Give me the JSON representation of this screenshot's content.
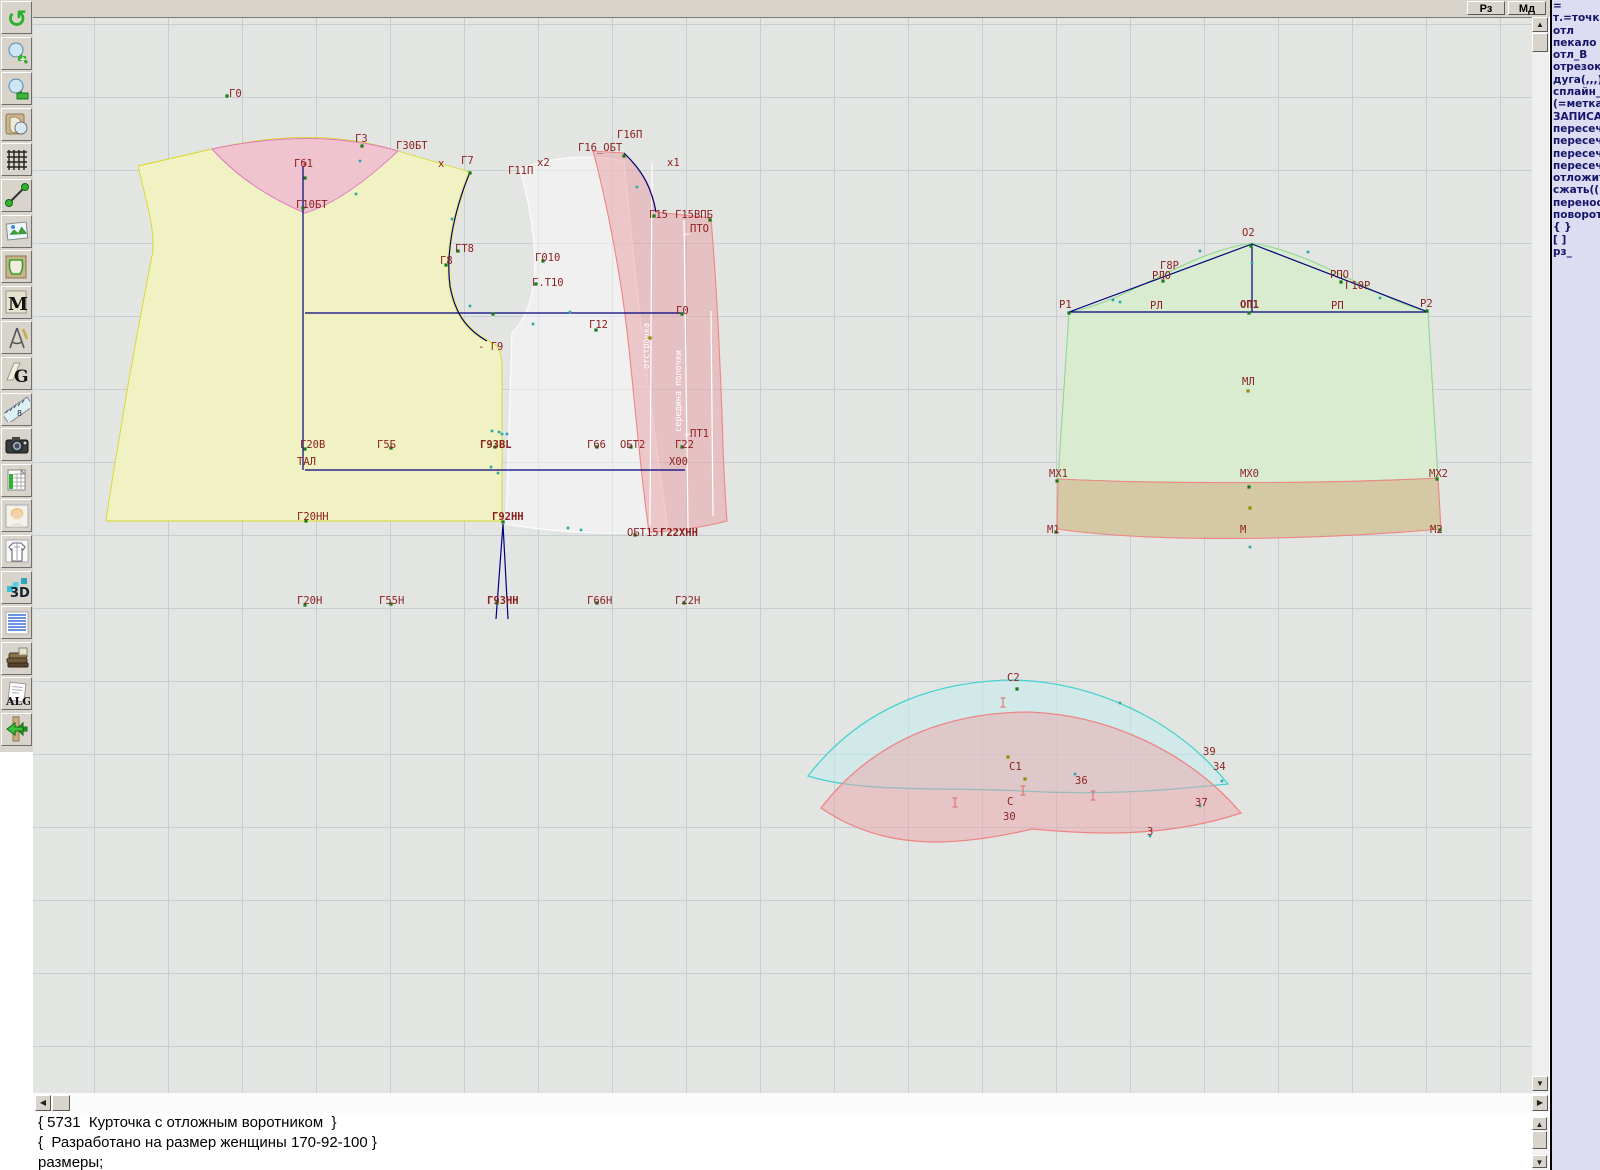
{
  "top_bar": {
    "buttons": [
      {
        "label": "Рз"
      },
      {
        "label": "Мд"
      }
    ]
  },
  "toolbar": {
    "items": [
      {
        "name": "undo-icon"
      },
      {
        "name": "zoom-in-icon"
      },
      {
        "name": "zoom-out-icon"
      },
      {
        "name": "preview-piece-icon"
      },
      {
        "name": "grid-icon"
      },
      {
        "name": "segment-icon"
      },
      {
        "name": "picture-icon"
      },
      {
        "name": "pattern-piece-icon"
      },
      {
        "name": "measurements-icon",
        "label": "M"
      },
      {
        "name": "drafting-compass-icon"
      },
      {
        "name": "grading-icon",
        "label": "G"
      },
      {
        "name": "ruler-icon",
        "label": "8"
      },
      {
        "name": "camera-icon"
      },
      {
        "name": "table-icon"
      },
      {
        "name": "model-photo-icon"
      },
      {
        "name": "garment-sketch-icon"
      },
      {
        "name": "3d-icon",
        "label": "3D"
      },
      {
        "name": "notes-icon"
      },
      {
        "name": "books-icon"
      },
      {
        "name": "algorithm-icon",
        "label": "ALG"
      },
      {
        "name": "exit-icon"
      }
    ]
  },
  "command_panel": {
    "lines": [
      "=",
      "т.=точка",
      "отл",
      "пекало",
      "отл_В",
      "отрезок",
      "дуга(,,,)",
      "сплайн_",
      "(=метка",
      "ЗАПИСА",
      "пересеч",
      "пересеч",
      "пересеч",
      "пересеч",
      "отложит",
      "сжать(()",
      "перенос",
      "поворот",
      "{  }",
      "[  ]",
      "рз_"
    ]
  },
  "console": {
    "lines": [
      "{ 5731  Курточка с отложным воротником  }",
      "{  Разработано на размер женщины 170-92-100 }",
      "размеры;"
    ]
  },
  "canvas": {
    "labels": [
      {
        "t": "Г0",
        "x": 229,
        "y": 96
      },
      {
        "t": "Г3",
        "x": 355,
        "y": 141
      },
      {
        "t": "Г30БТ",
        "x": 396,
        "y": 148
      },
      {
        "t": "Гб1",
        "x": 294,
        "y": 166
      },
      {
        "t": "Г10БТ",
        "x": 296,
        "y": 207
      },
      {
        "t": "х",
        "x": 438,
        "y": 166
      },
      {
        "t": "Г7",
        "x": 461,
        "y": 163
      },
      {
        "t": "х2",
        "x": 537,
        "y": 165
      },
      {
        "t": "Г11П",
        "x": 508,
        "y": 173
      },
      {
        "t": "Г16_ОБТ",
        "x": 578,
        "y": 150
      },
      {
        "t": "Г16П",
        "x": 617,
        "y": 137
      },
      {
        "t": "х1",
        "x": 667,
        "y": 165
      },
      {
        "t": "Г15",
        "x": 649,
        "y": 217
      },
      {
        "t": "Г15ВПБ",
        "x": 675,
        "y": 217
      },
      {
        "t": "ПТО",
        "x": 690,
        "y": 231
      },
      {
        "t": "ГТ8",
        "x": 455,
        "y": 251
      },
      {
        "t": "Г8",
        "x": 440,
        "y": 263
      },
      {
        "t": "Г010",
        "x": 535,
        "y": 260
      },
      {
        "t": "Г.Т10",
        "x": 532,
        "y": 285
      },
      {
        "t": "Г0",
        "x": 676,
        "y": 313
      },
      {
        "t": "Г12",
        "x": 589,
        "y": 327
      },
      {
        "t": "- Г9",
        "x": 478,
        "y": 349
      },
      {
        "t": "Г20В",
        "x": 300,
        "y": 447
      },
      {
        "t": "Г5Б",
        "x": 377,
        "y": 447
      },
      {
        "t": "Г9ЗВL",
        "x": 480,
        "y": 447,
        "b": 1
      },
      {
        "t": "Г66",
        "x": 587,
        "y": 447
      },
      {
        "t": "ОБТ2",
        "x": 620,
        "y": 447
      },
      {
        "t": "Г22",
        "x": 675,
        "y": 447
      },
      {
        "t": "ПТ1",
        "x": 690,
        "y": 436
      },
      {
        "t": "ТАЛ",
        "x": 297,
        "y": 464
      },
      {
        "t": "Х00",
        "x": 669,
        "y": 464
      },
      {
        "t": "Г20НН",
        "x": 297,
        "y": 519
      },
      {
        "t": "Г92НН",
        "x": 492,
        "y": 519,
        "b": 1
      },
      {
        "t": "ОБТ15",
        "x": 627,
        "y": 535
      },
      {
        "t": "Г22ХНН",
        "x": 660,
        "y": 535,
        "b": 1
      },
      {
        "t": "Г20Н",
        "x": 297,
        "y": 603
      },
      {
        "t": "Г55Н",
        "x": 379,
        "y": 603
      },
      {
        "t": "Г9ЗНН",
        "x": 487,
        "y": 603,
        "b": 1
      },
      {
        "t": "Г66Н",
        "x": 587,
        "y": 603
      },
      {
        "t": "Г22Н",
        "x": 675,
        "y": 603
      },
      {
        "t": "О2",
        "x": 1242,
        "y": 235
      },
      {
        "t": "Г8Р",
        "x": 1160,
        "y": 268
      },
      {
        "t": "РЛО",
        "x": 1152,
        "y": 278
      },
      {
        "t": "РПО",
        "x": 1330,
        "y": 277
      },
      {
        "t": "Г10Р",
        "x": 1345,
        "y": 288
      },
      {
        "t": "Р1",
        "x": 1059,
        "y": 307
      },
      {
        "t": "РЛ",
        "x": 1150,
        "y": 308
      },
      {
        "t": "ОП1",
        "x": 1240,
        "y": 307,
        "b": 1
      },
      {
        "t": "РП",
        "x": 1331,
        "y": 308
      },
      {
        "t": "Р2",
        "x": 1420,
        "y": 306
      },
      {
        "t": "МЛ",
        "x": 1242,
        "y": 384
      },
      {
        "t": "МХ1",
        "x": 1049,
        "y": 476
      },
      {
        "t": "МХ0",
        "x": 1240,
        "y": 476
      },
      {
        "t": "МХ2",
        "x": 1429,
        "y": 476
      },
      {
        "t": "М1",
        "x": 1047,
        "y": 532
      },
      {
        "t": "М",
        "x": 1240,
        "y": 532
      },
      {
        "t": "М2",
        "x": 1430,
        "y": 532
      },
      {
        "t": "С2",
        "x": 1007,
        "y": 680
      },
      {
        "t": "С1",
        "x": 1009,
        "y": 769
      },
      {
        "t": "С",
        "x": 1007,
        "y": 804
      },
      {
        "t": "30",
        "x": 1003,
        "y": 819
      },
      {
        "t": "З6",
        "x": 1075,
        "y": 783
      },
      {
        "t": "З9",
        "x": 1203,
        "y": 754
      },
      {
        "t": "З4",
        "x": 1213,
        "y": 769
      },
      {
        "t": "З7",
        "x": 1195,
        "y": 805
      },
      {
        "t": "З",
        "x": 1147,
        "y": 834
      },
      {
        "t": "⌐",
        "x": 684,
        "y": 237,
        "c": "#ffffff"
      },
      {
        "t": "⌐",
        "x": 685,
        "y": 437,
        "c": "#ffffff"
      }
    ],
    "rotated_labels": [
      {
        "t": "отстрочка",
        "x": 649,
        "y": 345
      },
      {
        "t": "середина полочки",
        "x": 681,
        "y": 390
      }
    ],
    "markers": [
      [
        227,
        95,
        "g"
      ],
      [
        305,
        163,
        "r"
      ],
      [
        305,
        177,
        "g"
      ],
      [
        303,
        207,
        "g"
      ],
      [
        362,
        145,
        "g"
      ],
      [
        360,
        160,
        "t"
      ],
      [
        356,
        193,
        "t"
      ],
      [
        470,
        172,
        "g"
      ],
      [
        452,
        218,
        "t"
      ],
      [
        458,
        250,
        "g"
      ],
      [
        446,
        264,
        "g"
      ],
      [
        470,
        305,
        "t"
      ],
      [
        493,
        313,
        "g"
      ],
      [
        533,
        323,
        "t"
      ],
      [
        543,
        260,
        "g"
      ],
      [
        536,
        283,
        "g"
      ],
      [
        624,
        155,
        "g"
      ],
      [
        637,
        186,
        "t"
      ],
      [
        654,
        215,
        "g"
      ],
      [
        710,
        219,
        "g"
      ],
      [
        682,
        313,
        "g"
      ],
      [
        596,
        329,
        "g"
      ],
      [
        570,
        311,
        "t"
      ],
      [
        650,
        337,
        "o"
      ],
      [
        305,
        448,
        "g"
      ],
      [
        391,
        447,
        "g"
      ],
      [
        495,
        446,
        "g"
      ],
      [
        597,
        446,
        "g"
      ],
      [
        631,
        446,
        "g"
      ],
      [
        682,
        446,
        "g"
      ],
      [
        492,
        430,
        "t"
      ],
      [
        499,
        431,
        "t"
      ],
      [
        491,
        466,
        "t"
      ],
      [
        498,
        472,
        "t"
      ],
      [
        306,
        520,
        "g"
      ],
      [
        503,
        521,
        "g"
      ],
      [
        568,
        527,
        "t"
      ],
      [
        581,
        529,
        "t"
      ],
      [
        635,
        534,
        "g"
      ],
      [
        502,
        433,
        "t"
      ],
      [
        507,
        433,
        "t"
      ],
      [
        305,
        604,
        "g"
      ],
      [
        391,
        603,
        "g"
      ],
      [
        497,
        602,
        "g"
      ],
      [
        597,
        602,
        "g"
      ],
      [
        684,
        602,
        "g"
      ],
      [
        1069,
        312,
        "g"
      ],
      [
        1251,
        245,
        "g"
      ],
      [
        1427,
        310,
        "g"
      ],
      [
        1249,
        312,
        "g"
      ],
      [
        1163,
        280,
        "g"
      ],
      [
        1341,
        281,
        "g"
      ],
      [
        1252,
        262,
        "t"
      ],
      [
        1113,
        299,
        "t"
      ],
      [
        1120,
        301,
        "t"
      ],
      [
        1200,
        250,
        "t"
      ],
      [
        1308,
        251,
        "t"
      ],
      [
        1380,
        297,
        "t"
      ],
      [
        1248,
        390,
        "o"
      ],
      [
        1057,
        480,
        "g"
      ],
      [
        1249,
        486,
        "g"
      ],
      [
        1437,
        478,
        "g"
      ],
      [
        1250,
        507,
        "o"
      ],
      [
        1056,
        531,
        "g"
      ],
      [
        1250,
        546,
        "t"
      ],
      [
        1440,
        529,
        "g"
      ],
      [
        1017,
        688,
        "g"
      ],
      [
        1120,
        702,
        "t"
      ],
      [
        1008,
        756,
        "o"
      ],
      [
        1025,
        778,
        "o"
      ],
      [
        1075,
        773,
        "t"
      ],
      [
        1222,
        780,
        "t"
      ],
      [
        1200,
        805,
        "t"
      ],
      [
        1150,
        835,
        "t"
      ]
    ],
    "ticks": [
      [
        1003,
        697
      ],
      [
        1023,
        785
      ],
      [
        955,
        797
      ],
      [
        1093,
        790
      ]
    ]
  },
  "colors": {
    "label": "#8b1e1e",
    "navy": "#000080",
    "piece_yellow": "#f1f2c3",
    "piece_pink": "#e07cc0",
    "piece_red": "#ee8585",
    "piece_green": "#8fd88f",
    "piece_cyan": "#4ad0d0",
    "band_tan": "#d4c8a5",
    "marker_green": "#157a15",
    "marker_teal": "#2aa8a8",
    "marker_olive": "#8f8f00"
  }
}
